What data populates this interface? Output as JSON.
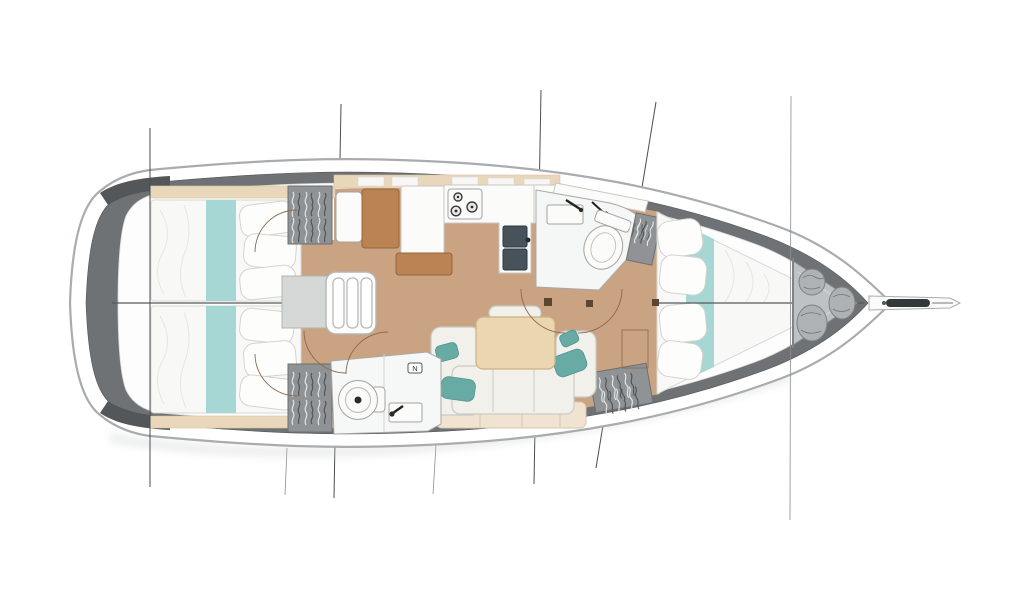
{
  "meta": {
    "title": "Sailing yacht interior layout — top-view deck plan, bow to the right",
    "diagram_type": "boat floor plan",
    "visible_text": "none except small N tag in aft head"
  },
  "labels": {
    "aft_head_tag": "N"
  },
  "rooms": [
    {
      "id": "transom",
      "name": "Stern platform"
    },
    {
      "id": "aft-cabin-port",
      "name": "Aft double cabin (port, top)"
    },
    {
      "id": "aft-cabin-starboard",
      "name": "Aft double cabin (starboard, bottom)"
    },
    {
      "id": "companionway",
      "name": "Companionway steps with landing"
    },
    {
      "id": "nav-station",
      "name": "Navigation station with chart table"
    },
    {
      "id": "galley",
      "name": "L-shaped galley with stove and double sink"
    },
    {
      "id": "saloon",
      "name": "Saloon with U-shaped sofa and dining table"
    },
    {
      "id": "aft-head",
      "name": "Aft head with toilet and washbasin"
    },
    {
      "id": "forward-head",
      "name": "Forward head with toilet and washbasin"
    },
    {
      "id": "forward-cabin",
      "name": "Forward owner cabin with tapered double berth"
    },
    {
      "id": "sail-locker",
      "name": "Bow sail locker with sail bags"
    },
    {
      "id": "bowsprit",
      "name": "Bowsprit with anchor roller"
    }
  ],
  "colors": {
    "hull_fill": "#ffffff",
    "hull_stroke": "#a8acae",
    "deck_band": "#6e7275",
    "deck_dark": "#53575a",
    "interior": "#fdfdfd",
    "interior_stroke": "#d8dadb",
    "wood_floor": "#c9a382",
    "wood_trim": "#e9d7bc",
    "wood_trim_stroke": "#d9c29e",
    "bed_white": "#f8f8f6",
    "bed_stroke": "#d8d8d5",
    "pillow": "#fdfdfc",
    "pillow_stroke": "#d3d3d0",
    "fold": "#e7e7e4",
    "teal_runner": "#a7d7d4",
    "teal_pillow": "#68aba4",
    "teal_pillow_stroke": "#4f948e",
    "locker_gray": "#8f9396",
    "locker_stroke": "#6b6f72",
    "hanger_light": "#e8eae9",
    "hanger_dark": "#4e5254",
    "step_gray": "#d6d8d7",
    "step_stroke": "#b3b5b4",
    "white_fixture": "#fbfbfa",
    "fixture_stroke": "#a3a3a0",
    "counter_stroke": "#c7c7c4",
    "sink_dark": "#47525a",
    "sink_dark_stroke": "#2f373d",
    "brown": "#bb8254",
    "brown_stroke": "#95653d",
    "table_wood": "#ead6b0",
    "table_stroke": "#cdb184",
    "sofa_cream": "#f1f0eb",
    "sofa_stroke": "#cbcbc5",
    "sofa_base": "#f0e3d1",
    "sofa_base_stroke": "#d8c7ac",
    "door_arc": "#8a6a4e",
    "hinge": "#5b4632",
    "line_dark": "#4a4d4f",
    "line_mid": "#8b8e90",
    "bag_gray": "#aeb2b4",
    "bag_stroke": "#7d8183",
    "bag_detail": "#6f7375",
    "locker_area": "#bfc2c4",
    "locker_area_stroke": "#8d9193",
    "anchor_dark": "#33383b",
    "shadow": "#c7cbcd",
    "centerline": "#55595c",
    "fixture_dark": "#2a2a28"
  }
}
